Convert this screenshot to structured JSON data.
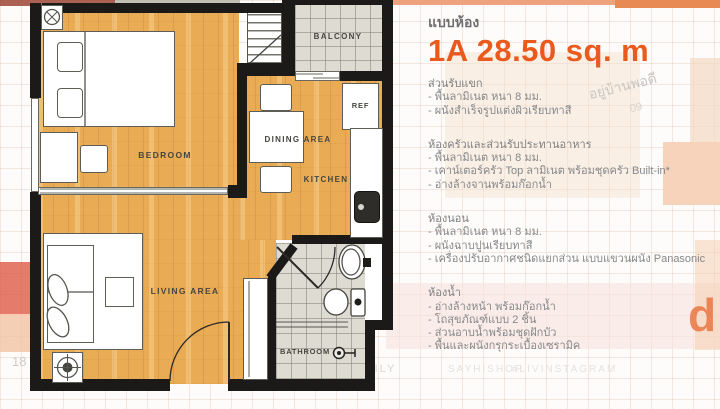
{
  "header": {
    "label": "แบบห้อง",
    "title": "1A 28.50 sq. m"
  },
  "specs": {
    "sections": [
      {
        "title": "ส่วนรับแขก",
        "items": [
          "- พื้นลามิเนต หนา 8 มม.",
          "- ผนังสำเร็จรูปแต่งผิวเรียบทาสี"
        ]
      },
      {
        "title": "ห้องครัวและส่วนรับประทานอาหาร",
        "items": [
          "- พื้นลามิเนต หนา 8 มม.",
          "- เคาน์เตอร์ครัว Top ลามิเนต พร้อมชุดครัว Built-in*",
          "- อ่างล้างจานพร้อมก๊อกน้ำ"
        ]
      },
      {
        "title": "ห้องนอน",
        "items": [
          "- พื้นลามิเนต หนา 8 มม.",
          "- ผนังฉาบปูนเรียบทาสี",
          "- เครื่องปรับอากาศชนิดแยกส่วน แบบแขวนผนัง Panasonic"
        ]
      },
      {
        "title": "ห้องน้ำ",
        "items": [
          "- อ่างล้างหน้า พร้อมก๊อกน้ำ",
          "- โถสุขภัณฑ์แบบ 2 ชิ้น",
          "- ส่วนอาบน้ำพร้อมชุดฝักบัว",
          "- พื้นและผนังกรุกระเบื้องเซรามิค"
        ]
      }
    ]
  },
  "plan": {
    "labels": {
      "bedroom": "BEDROOM",
      "dining": "DINING AREA",
      "kitchen": "KITCHEN",
      "living": "LIVING AREA",
      "bathroom": "BATHROOM",
      "balcony": "BALCONY",
      "ref": "REF"
    }
  },
  "background": {
    "watermarks": {
      "brand": "อยู่บ้านพอดี",
      "number": "09",
      "family": "FAMILY",
      "shop": "SAYHISHOP",
      "hashtag": "#LIVINSTAGRAM",
      "partial_logo": "d",
      "left_partial": "18"
    }
  },
  "colors": {
    "accent_orange": "#EA5A1D",
    "heading_gray": "#6D6E71",
    "body_gray": "#86888B",
    "wood": "#E9AB54",
    "wall": "#1B1A18"
  }
}
